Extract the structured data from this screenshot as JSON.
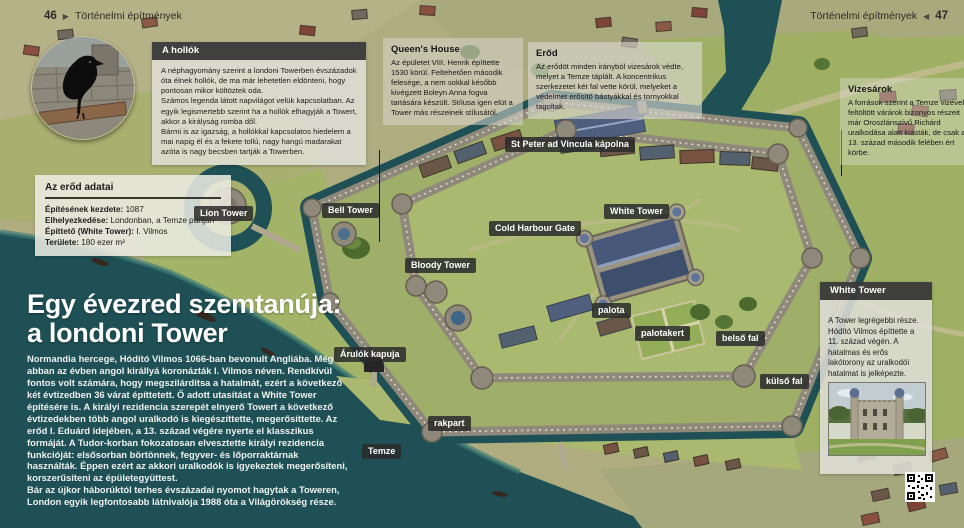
{
  "page": {
    "left_number": "46",
    "right_number": "47",
    "section_title": "Történelmi építmények",
    "arrow_right": "▶",
    "arrow_left": "◀"
  },
  "headline": {
    "line1": "Egy évezred szemtanúja:",
    "line2": "a londoni Tower"
  },
  "intro": "Normandia hercege, Hódító Vilmos 1066-ban bevonult Angliába. Még abban az évben angol királlyá koronázták I. Vilmos néven. Rendkívül fontos volt számára, hogy megszilárdítsa a hatalmát, ezért a következő két évtizedben 36 várat építtetett. Ő adott utasítást a White Tower építésére is. A királyi rezidencia szerepét elnyerő Towert a következő évtizedekben több angol uralkodó is kiegészíttette, megerősíttette. Az erőd I. Eduárd idejében, a 13. század végére nyerte el klasszikus formáját. A Tudor-korban fokozatosan elvesztette királyi rezidencia funkcióját: elsősorban börtönnek, fegyver- és lőporraktárnak használták. Éppen ezért az akkori uralkodók is igyekeztek megerősíteni, korszerűsíteni az épületegyüttest.\nBár az újkor háborúktól terhes évszázadai nyomot hagytak a Toweren, London egyik legfontosabb látnivalója 1988 óta a Világörökség része.",
  "boxes": {
    "ravens": {
      "title": "A hollók",
      "text": "A néphagyomány szerint a londoni Towerben évszázadok óta élnek hollók, de ma már lehetetlen eldönteni, hogy pontosan mikor költöztek oda.\nSzámos legenda látott napvilágot velük kapcsolatban. Az egyik legismertebb szerint ha a hollók elhagyják a Towert, akkor a királyság romba dől.\nBármi is az igazság, a hollókkal kapcsolatos hiedelem a mai napig él és a fekete tollú, nagy hangú madarakat azóta is nagy becsben tartják a Towerben."
    },
    "fort_data": {
      "title": "Az erőd adatai",
      "rows": [
        {
          "label": "Építésének kezdete:",
          "value": "1087"
        },
        {
          "label": "Elhelyezkedése:",
          "value": "Londonban, a Temze partján"
        },
        {
          "label": "Építtető (White Tower):",
          "value": "I. Vilmos"
        },
        {
          "label": "Területe:",
          "value": "180 ezer m²"
        }
      ]
    },
    "queens_house": {
      "title": "Queen's House",
      "text": "Az épületet VIII. Henrik építtette 1530 körül. Feltehetően második felesége, a nem sokkal később kivégzett Boleyn Anna fogva tartására készült. Stílusa igen elüt a Tower más részeinek stílusától."
    },
    "fortress": {
      "title": "Erőd",
      "text": "Az erődöt minden irányból vizesárok védte, melyet a Temze táplált. A koncentrikus szerkezetet két fal vette körül, melyeket a védelmet erősítő bástyákkal és tornyokkal tagoltak."
    },
    "moat": {
      "title": "Vizesárok",
      "text": "A források szerint a Temze vizével feltöltött várárok bizonyos részeit már Oroszlánszívű Richárd uralkodása alatt kiásták, de csak a 13. század második felében ért körbe."
    },
    "white_tower": {
      "title": "White Tower",
      "text": "A Tower legrégebbi része. Hódító Vilmos építtette a 11. század végén. A hatalmas és erős lakótorony az uralkodói hatalmat is jelképezte."
    }
  },
  "map_labels": [
    {
      "text": "St Peter ad Vincula kápolna"
    },
    {
      "text": "Lion Tower"
    },
    {
      "text": "Bell Tower"
    },
    {
      "text": "White Tower"
    },
    {
      "text": "Cold Harbour Gate"
    },
    {
      "text": "Bloody Tower"
    },
    {
      "text": "palota"
    },
    {
      "text": "palotakert"
    },
    {
      "text": "belső fal"
    },
    {
      "text": "külső fal"
    },
    {
      "text": "Árulók kapuja"
    },
    {
      "text": "rakpart"
    },
    {
      "text": "Temze"
    }
  ],
  "colors": {
    "water": "#1e5055",
    "grass": "#a4b469",
    "stone_wall": "#8f897b",
    "slate_roof": "#47587a",
    "label_bg": "#2a2a2a"
  }
}
